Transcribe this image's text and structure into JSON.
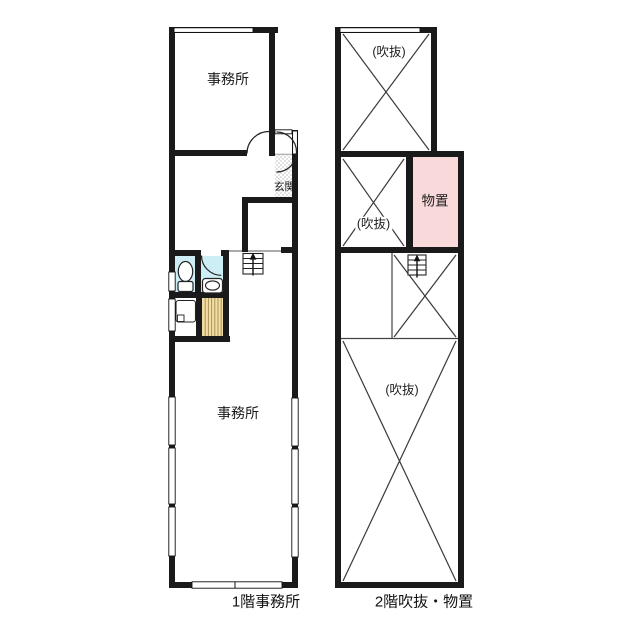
{
  "floor1": {
    "caption": "1階事務所",
    "office_upper_label": "事務所",
    "office_main_label": "事務所",
    "entrance_label": "玄関"
  },
  "floor2": {
    "caption": "2階吹抜・物置",
    "void_top_label": "(吹抜)",
    "void_mid_label": "(吹抜)",
    "storage_label": "物置",
    "void_bottom_label": "(吹抜)"
  },
  "colors": {
    "wall": "#1a1a1a",
    "wet_room_cyan": "#cdeef4",
    "storage_pink": "#f9d9d9",
    "stairs_tan": "#f2dda2",
    "hatch_gray": "#e2e2e2"
  }
}
